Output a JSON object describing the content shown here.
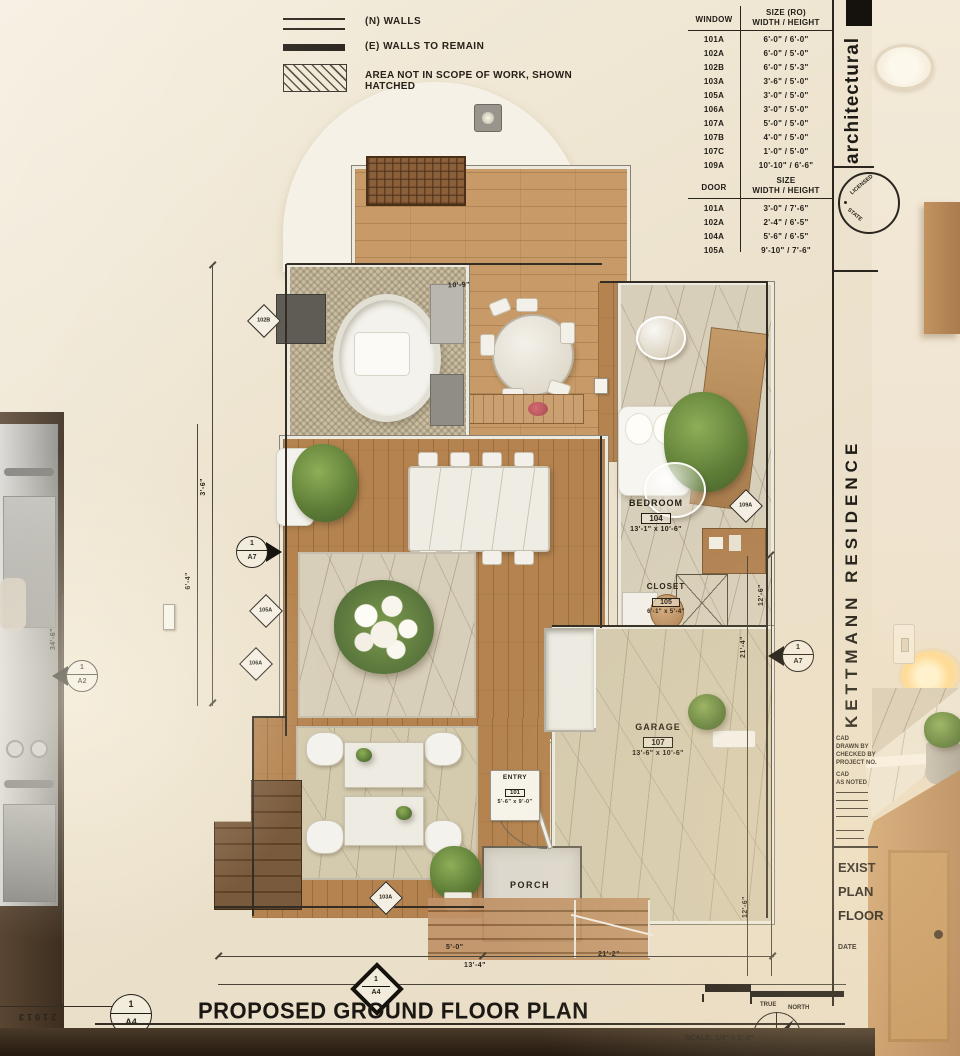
{
  "colors": {
    "paper": "#ece2cd",
    "ink": "#241f17",
    "wood_light": "#c79a67",
    "wood_mid": "#b4834f",
    "marble": "#d8cfba",
    "plant_green": "#5d7d37",
    "steel": "#b9b8b3"
  },
  "legend": {
    "items": [
      {
        "symbol": "double-line",
        "label": "(N) WALLS"
      },
      {
        "symbol": "solid-line",
        "label": "(E) WALLS TO REMAIN"
      },
      {
        "symbol": "hatched-area",
        "label": "AREA NOT IN SCOPE OF WORK, SHOWN HATCHED"
      }
    ]
  },
  "window_schedule": {
    "header_col1": "WINDOW",
    "header_col2_line1": "SIZE (RO)",
    "header_col2_line2": "WIDTH / HEIGHT",
    "rows": [
      {
        "id": "101A",
        "size": "6'-0\" / 6'-0\""
      },
      {
        "id": "102A",
        "size": "6'-0\" / 5'-0\""
      },
      {
        "id": "102B",
        "size": "6'-0\" / 5'-3\""
      },
      {
        "id": "103A",
        "size": "3'-6\" / 5'-0\""
      },
      {
        "id": "105A",
        "size": "3'-0\" / 5'-0\""
      },
      {
        "id": "106A",
        "size": "3'-0\" / 5'-0\""
      },
      {
        "id": "107A",
        "size": "5'-0\" / 5'-0\""
      },
      {
        "id": "107B",
        "size": "4'-0\" / 5'-0\""
      },
      {
        "id": "107C",
        "size": "1'-0\" / 5'-0\""
      },
      {
        "id": "109A",
        "size": "10'-10\" / 6'-6\""
      }
    ]
  },
  "door_schedule": {
    "header_col1": "DOOR",
    "header_col2_line1": "SIZE",
    "header_col2_line2": "WIDTH / HEIGHT",
    "rows": [
      {
        "id": "101A",
        "size": "3'-0\" / 7'-6\""
      },
      {
        "id": "102A",
        "size": "2'-4\" / 6'-5\""
      },
      {
        "id": "104A",
        "size": "5'-6\" / 6'-5\""
      },
      {
        "id": "105A",
        "size": "9'-10\" / 7'-6\""
      }
    ]
  },
  "title_block": {
    "firm": "architectural",
    "stamp_line1": "LICENSED",
    "stamp_line2": "STATE",
    "project": "KETTMANN RESIDENCE",
    "info_lines": [
      "CAD",
      "DRAWN BY",
      "CHECKED BY",
      "PROJECT NO.",
      "CAD",
      "AS NOTED"
    ],
    "sheet_title_lines": [
      "EXIST",
      "PLAN",
      "FLOOR"
    ],
    "date_label": "DATE"
  },
  "plan": {
    "rooms": [
      {
        "name": "BEDROOM",
        "number": "104",
        "size": "13'-1\" x 10'-6\""
      },
      {
        "name": "CLOSET",
        "number": "105",
        "size": "6'-1\" x 5'-4\""
      },
      {
        "name": "GARAGE",
        "number": "107",
        "size": "13'-6\" x 10'-6\""
      },
      {
        "name": "ENTRY",
        "number": "101",
        "size": "5'-6\" x 9'-0\""
      },
      {
        "name": "PORCH",
        "number": "",
        "size": ""
      }
    ],
    "tags": [
      "102B",
      "105A",
      "106A",
      "103A",
      "109A"
    ],
    "markers": [
      {
        "num": "1",
        "sheet": "A7"
      },
      {
        "num": "1",
        "sheet": "A2"
      },
      {
        "num": "1",
        "sheet": "A7"
      }
    ],
    "dims": [
      "10'-9\"",
      "3'-6\"",
      "6'-4\"",
      "34'-6\"",
      "12'-6\"",
      "21'-4\"",
      "12'-6\"",
      "5'-0\"",
      "13'-4\"",
      "21'-2\""
    ]
  },
  "footer": {
    "ref_num": "1",
    "ref_sheet": "A4",
    "north_num": "1",
    "north_sheet": "A4",
    "title": "PROPOSED GROUND FLOOR PLAN",
    "scale_text": "SCALE: 1/4\" = 1'-0\"",
    "compass_label_1": "TRUE",
    "compass_label_2": "NORTH",
    "scale_bar_text": "21013"
  }
}
